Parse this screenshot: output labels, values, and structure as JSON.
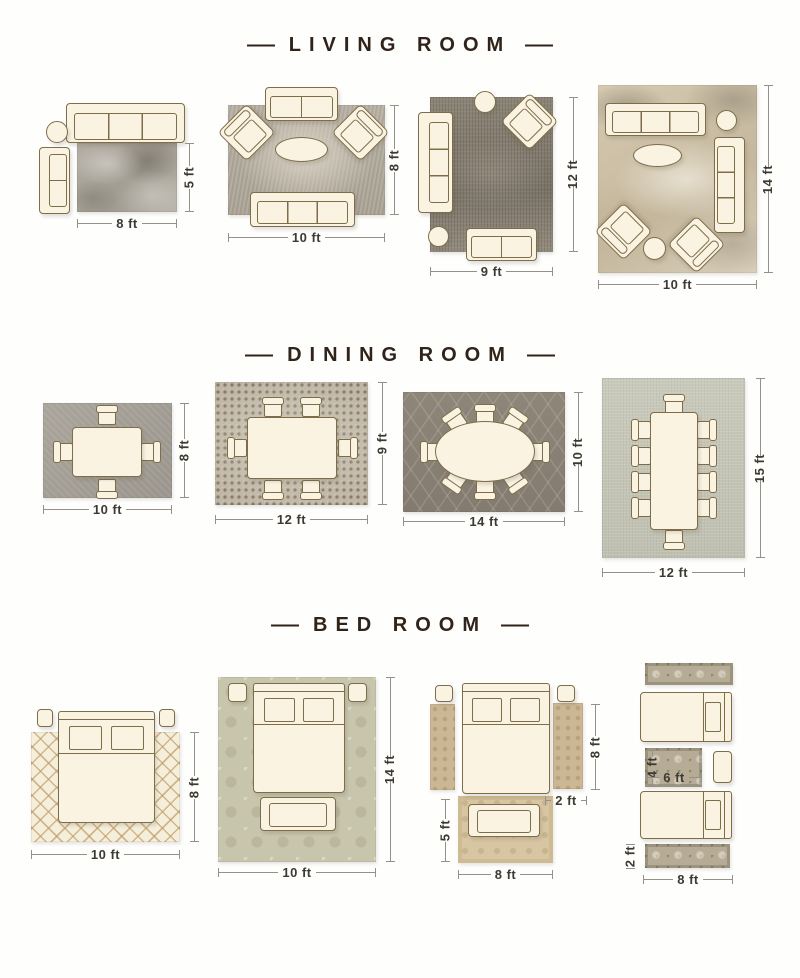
{
  "palette": {
    "title_text": "#30231a",
    "dim_text": "#3e3a32",
    "dim_line": "#94918a",
    "furniture_fill": "#faf3e2",
    "furniture_outline": "#7e6d49",
    "background": "#fefefd"
  },
  "sections": [
    {
      "name": "living-room",
      "title": "LIVING ROOM",
      "dash_left": "—",
      "dash_right": "—",
      "layouts": [
        {
          "width_label": "8 ft",
          "height_label": "5 ft",
          "rug_color": "#a9a399"
        },
        {
          "width_label": "10 ft",
          "height_label": "8 ft",
          "rug_color": "#b3ac9f"
        },
        {
          "width_label": "9 ft",
          "height_label": "12 ft",
          "rug_color": "#857d6f"
        },
        {
          "width_label": "10 ft",
          "height_label": "14 ft",
          "rug_color": "#ccbfa6"
        }
      ]
    },
    {
      "name": "dining-room",
      "title": "DINING ROOM",
      "dash_left": "—",
      "dash_right": "—",
      "layouts": [
        {
          "width_label": "10 ft",
          "height_label": "8 ft",
          "rug_color": "#a49f96"
        },
        {
          "width_label": "12 ft",
          "height_label": "9 ft",
          "rug_color": "#bdb4a3"
        },
        {
          "width_label": "14 ft",
          "height_label": "10 ft",
          "rug_color": "#8a8275"
        },
        {
          "width_label": "12 ft",
          "height_label": "15 ft",
          "rug_color": "#c5c6b8"
        }
      ]
    },
    {
      "name": "bed-room",
      "title": "BED ROOM",
      "dash_left": "—",
      "dash_right": "—",
      "layouts": [
        {
          "width_label": "10 ft",
          "height_label": "8 ft",
          "rug_color": "#f3ebd7"
        },
        {
          "width_label": "10 ft",
          "height_label": "14 ft",
          "rug_color": "#c8c5ad"
        },
        {
          "side_runner_height_label": "8 ft",
          "side_runner_width_label": "2 ft",
          "foot_rug_height_label": "5 ft",
          "foot_rug_width_label": "8 ft",
          "rug_color": "#d7c5a2"
        },
        {
          "center_rug_height_label": "4 ft",
          "center_rug_width_label": "6 ft",
          "runner_height_label": "2 ft",
          "width_label": "8 ft",
          "rug_color": "#b6ac96"
        }
      ]
    }
  ]
}
